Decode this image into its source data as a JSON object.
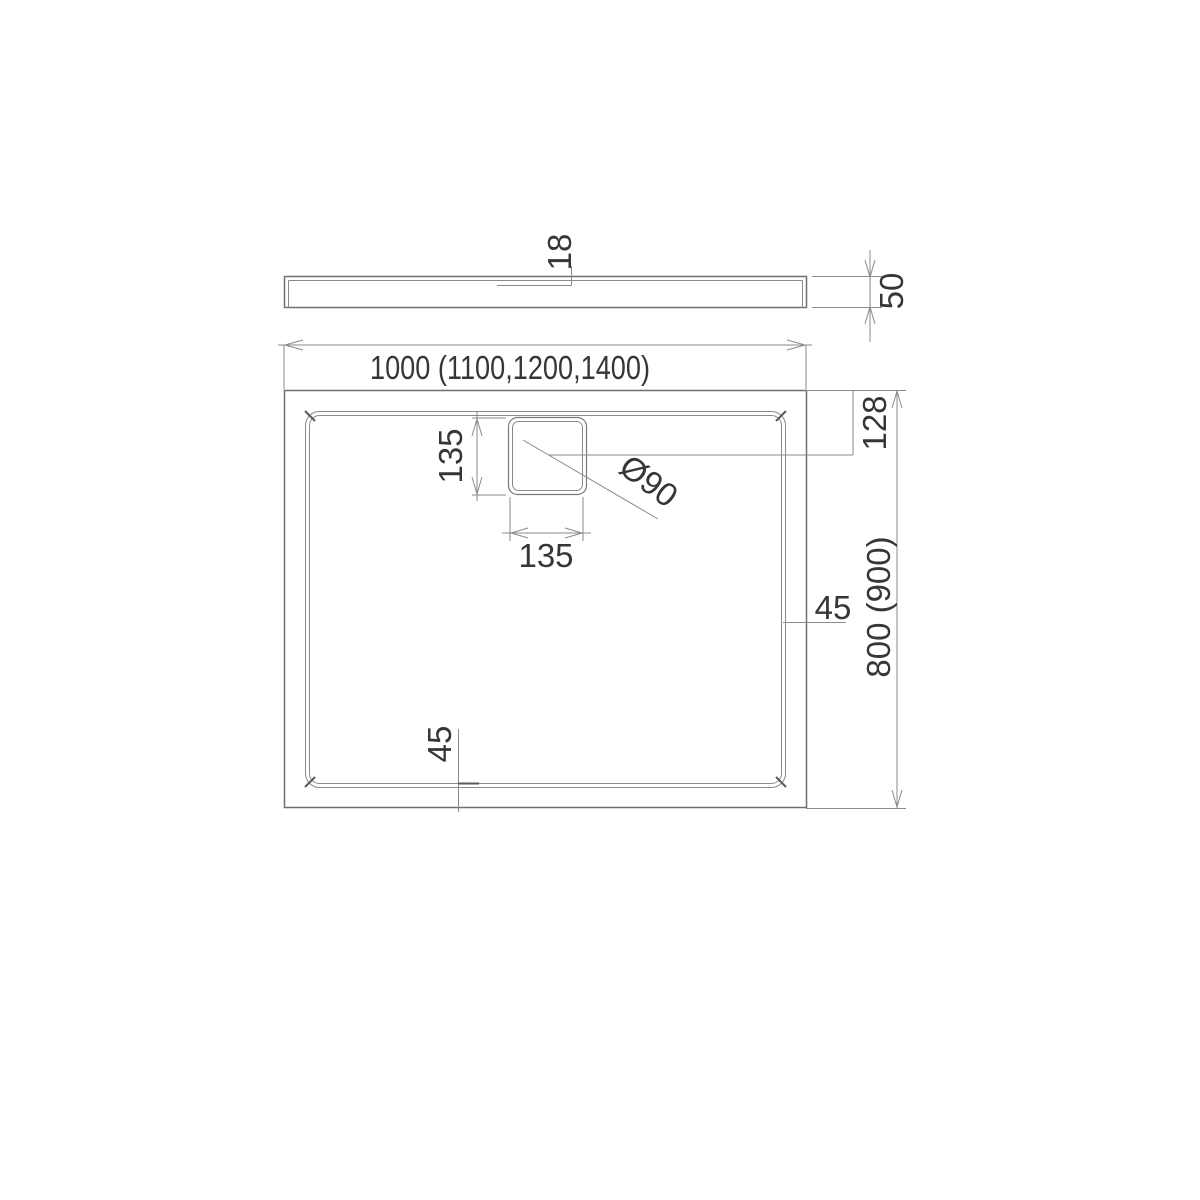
{
  "drawing": {
    "side_view": {
      "top_thickness_label": "18",
      "height_label": "50"
    },
    "plan_view": {
      "overall_width_label": "1000 (1100,1200,1400)",
      "overall_depth_label": "800 (900)",
      "drain_offset_label": "128",
      "drain_width_label": "135",
      "drain_height_label": "135",
      "drain_diameter_label": "Ø90",
      "rim_width_right_label": "45",
      "rim_width_bottom_label": "45"
    },
    "colors": {
      "line": "#8a8a8a",
      "object_line": "#6f6f6f",
      "text": "#363636",
      "background": "#ffffff"
    }
  }
}
